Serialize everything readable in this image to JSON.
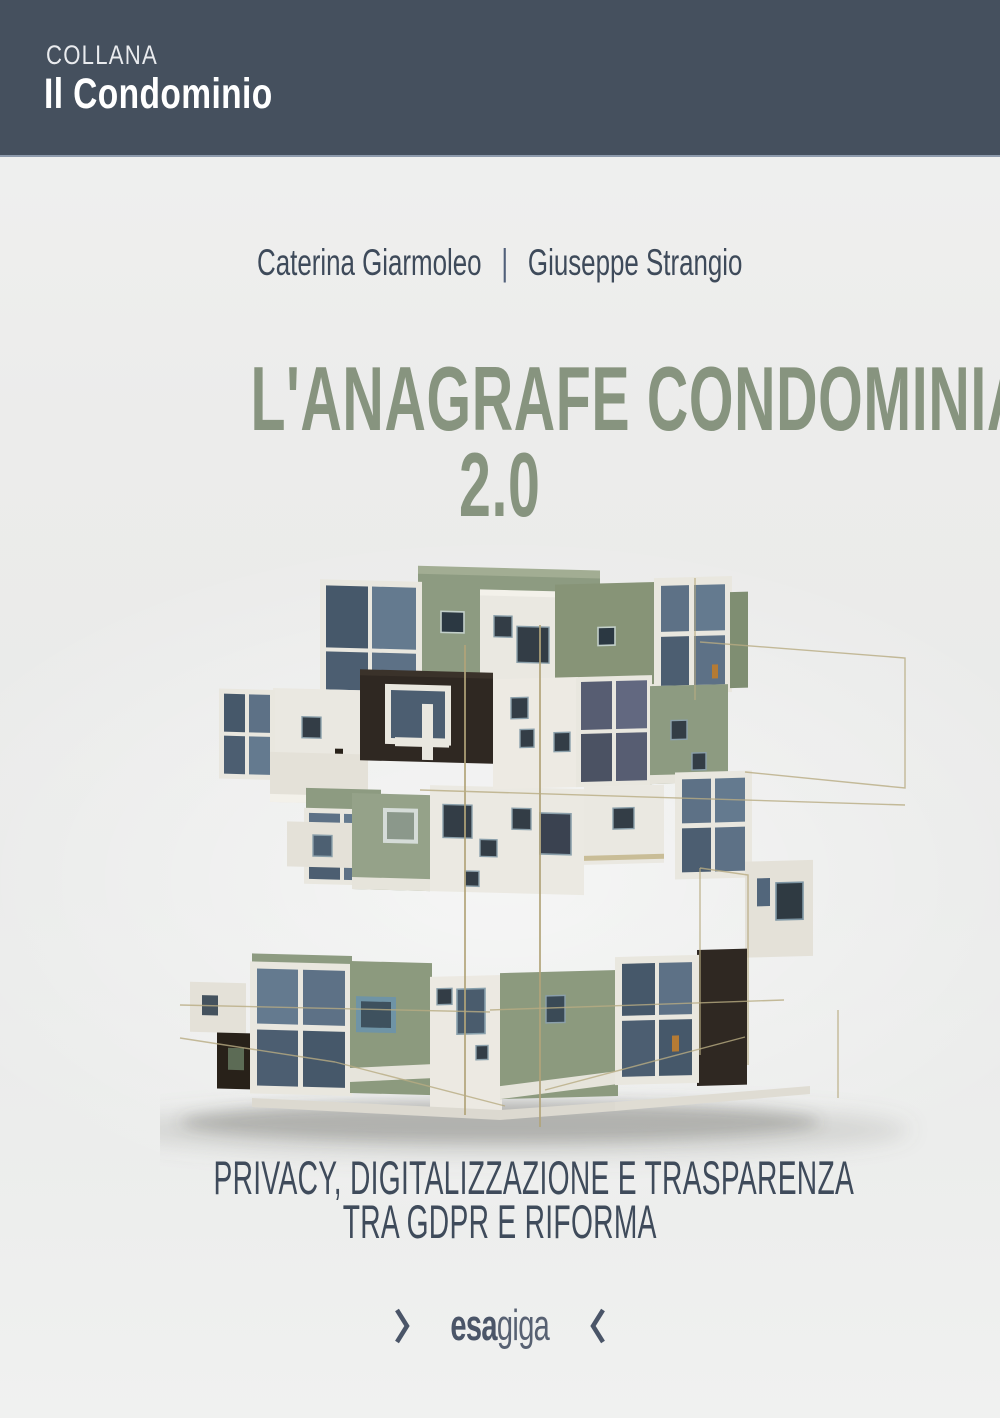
{
  "banner": {
    "collection_label": "COLLANA",
    "collection_name": "Il Condominio"
  },
  "authors": {
    "first": "Caterina Giarmoleo",
    "separator": "|",
    "second": "Giuseppe Strangio"
  },
  "title": {
    "line1": "L'ANAGRAFE CONDOMINIALE",
    "line2": "2.0"
  },
  "subtitle": {
    "line1": "PRIVACY, DIGITALIZZAZIONE E TRASPARENZA",
    "line2": "TRA GDPR E RIFORMA"
  },
  "publisher": {
    "name_bold": "esa",
    "name_light": "giga"
  },
  "illustration": {
    "label": "stacked modular building model"
  },
  "colors": {
    "banner_background": "#45505e",
    "title_green": "#87947f",
    "slate_text": "#3f4b5b",
    "page_background": "#ededec",
    "building_green": "#8d9b81",
    "building_cream": "#eae8e1",
    "building_dark": "#2f2822",
    "building_glass": "#5d7186",
    "wire_gold": "#b2a379"
  }
}
